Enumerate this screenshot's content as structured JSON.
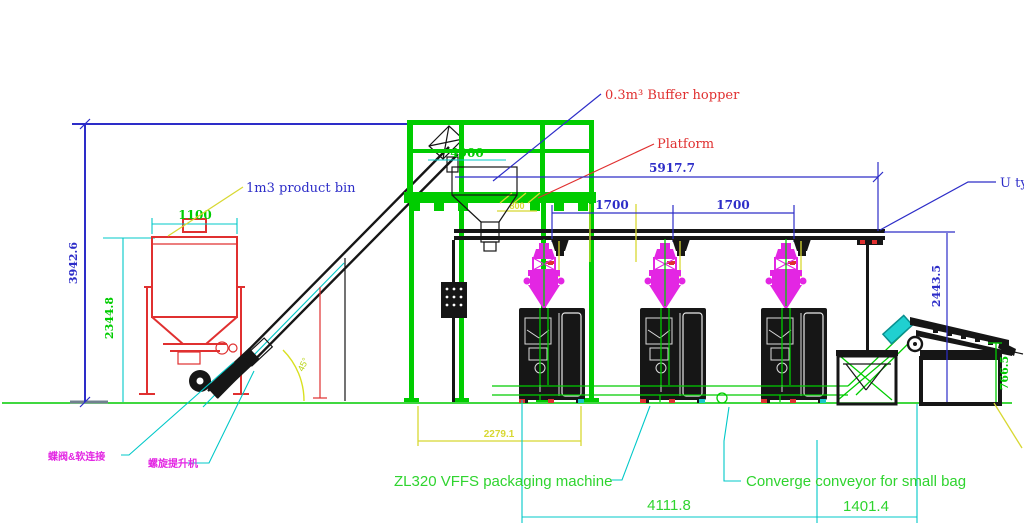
{
  "labels": {
    "product_bin": "1m3 product bin",
    "buffer_hopper": "0.3m³ Buffer hopper",
    "platform": "Platform",
    "u_conveyor": "U ty",
    "vffs": "ZL320 VFFS packaging machine",
    "converge": "Converge conveyor for small bag",
    "valve_cn": "蝶阀&软连接",
    "screw_cn": "螺旋提升机",
    "angle": "45°"
  },
  "dimensions": {
    "total_height": "3942.6",
    "bin_height": "2344.8",
    "bin_width": "1100",
    "platform_len": "4900",
    "overall_span": "5917.7",
    "pitch1": "1700",
    "pitch2": "1700",
    "outlet": "800",
    "platform_span": "2279.1",
    "u_height": "2443.5",
    "discharge_height": "766.5",
    "line_len": "4111.8",
    "outfeed_len": "1401.4"
  },
  "colors": {
    "dimension_blue": "#2d2dc8",
    "cad_green": "#00cc00",
    "label_green": "#2fd42f",
    "machine_red": "#e03030",
    "weigher_magenta": "#e326e3",
    "leader_cyan": "#00c8c8",
    "dim_yellow": "#d8d832",
    "machine_black": "#161616"
  }
}
